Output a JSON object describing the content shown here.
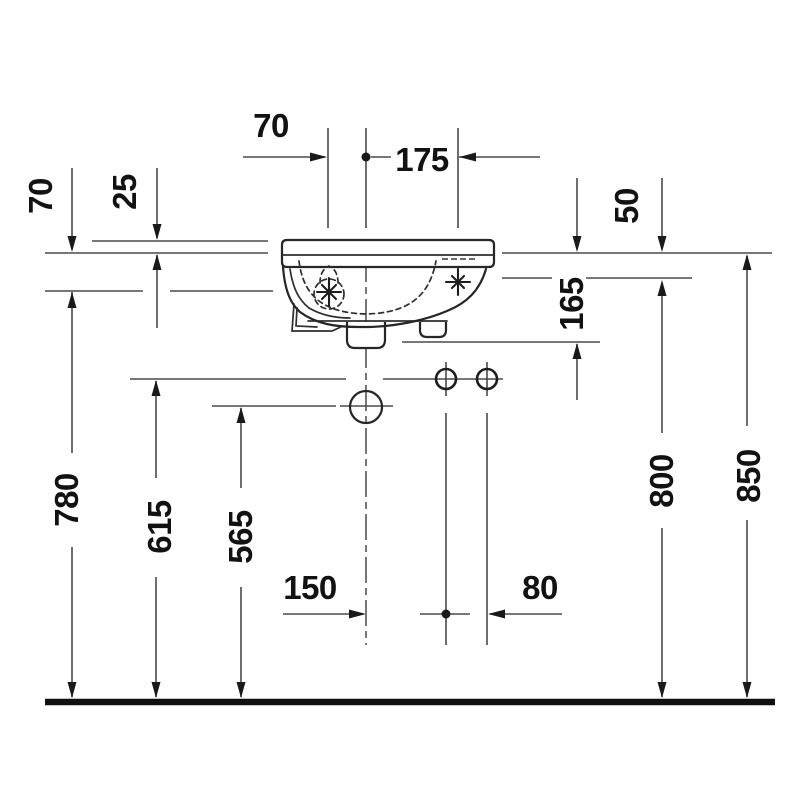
{
  "drawing": {
    "description": "Technical installation drawing (front elevation) of a wall-mounted hand-rinse basin with drain, tap holes and fixing points over a floor line",
    "colors": {
      "background": "#ffffff",
      "dimension_line": "#4a4a4a",
      "object_line": "#262626",
      "text": "#121212"
    },
    "dims": {
      "top_left": "70",
      "top_right": "175",
      "upper_left_outer": "70",
      "upper_left_inner": "25",
      "upper_right_inner": "50",
      "upper_right_depth": "165",
      "height_outer_left": "780",
      "height_mid_left": "615",
      "height_inner_left": "565",
      "bottom_left": "150",
      "bottom_right": "80",
      "height_inner_right": "800",
      "height_outer_right": "850"
    }
  }
}
